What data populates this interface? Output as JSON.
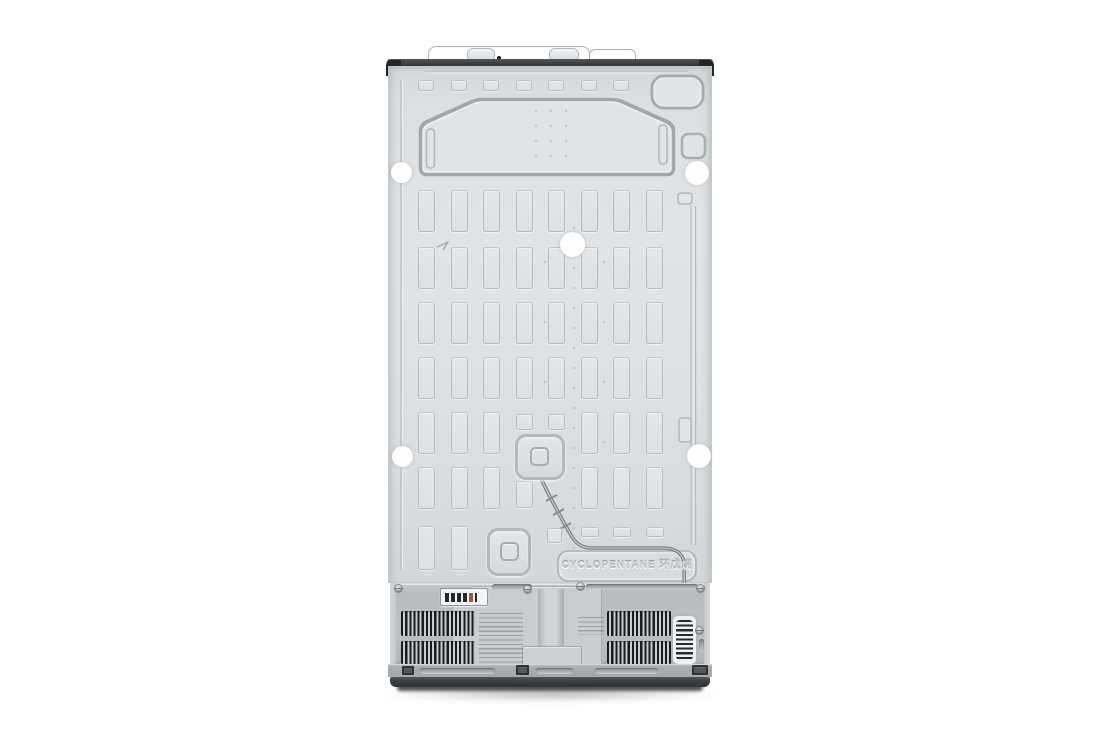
{
  "embossed": {
    "refrigerant_label": "CYCLOPENTANE 环戊烷"
  },
  "colors": {
    "background": "#ffffff",
    "panel": "#dadddf",
    "panel-light": "#e5e7e9",
    "panel-edge": "#c3c7c9",
    "groove": "#a3a8ab",
    "trim-dark": "#3a3d3f",
    "corner-dark": "#232527",
    "compartment": "#bcc0c2",
    "plate": "#c9cdcf",
    "slat-dark": "#1a1b1d",
    "base": "#a4a8aa",
    "plinth": "#454748",
    "sticker": "#fefefe",
    "tube": "#7d8285",
    "label-bar": "#26272a",
    "label-accent": "#9a5b3e"
  }
}
